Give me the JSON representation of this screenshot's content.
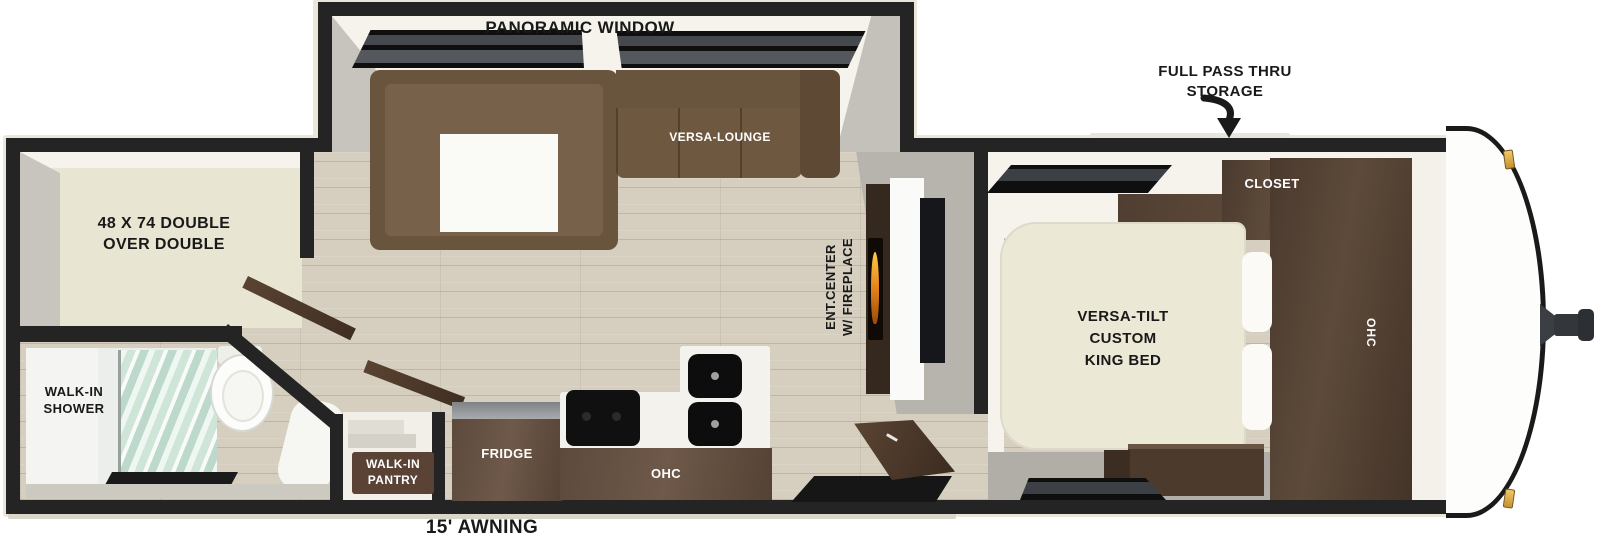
{
  "colors": {
    "wall": "#242424",
    "exterior_trim": "#eae7da",
    "wood_floor": "#d6cfc0",
    "cabinet_walnut": "#5d4a3a",
    "sofa_brown": "#69543e",
    "bed_cream": "#ece8d6",
    "bunk_cream": "#e9e5d3",
    "shower_glass": "#cfe5d8",
    "fireplace_flame": "#e8891f",
    "marker_light_gold": "#e0aa45",
    "window_black": "#0f0f0f"
  },
  "labels": {
    "panoramic_window": "PANORAMIC WINDOW",
    "full_pass_thru_1": "FULL PASS THRU",
    "full_pass_thru_2": "STORAGE",
    "versa_lounge": "VERSA-LOUNGE",
    "bunk_1": "48 X 74 DOUBLE",
    "bunk_2": "OVER DOUBLE",
    "shower_1": "WALK-IN",
    "shower_2": "SHOWER",
    "pantry_1": "WALK-IN",
    "pantry_2": "PANTRY",
    "fridge": "FRIDGE",
    "kitchen_ohc": "OHC",
    "ent_1": "ENT.CENTER",
    "ent_2": "W/ FIREPLACE",
    "closet": "CLOSET",
    "bedroom_ohc": "OHC",
    "bed_1": "VERSA-TILT",
    "bed_2": "CUSTOM",
    "bed_3": "KING BED",
    "awning": "15' AWNING"
  }
}
